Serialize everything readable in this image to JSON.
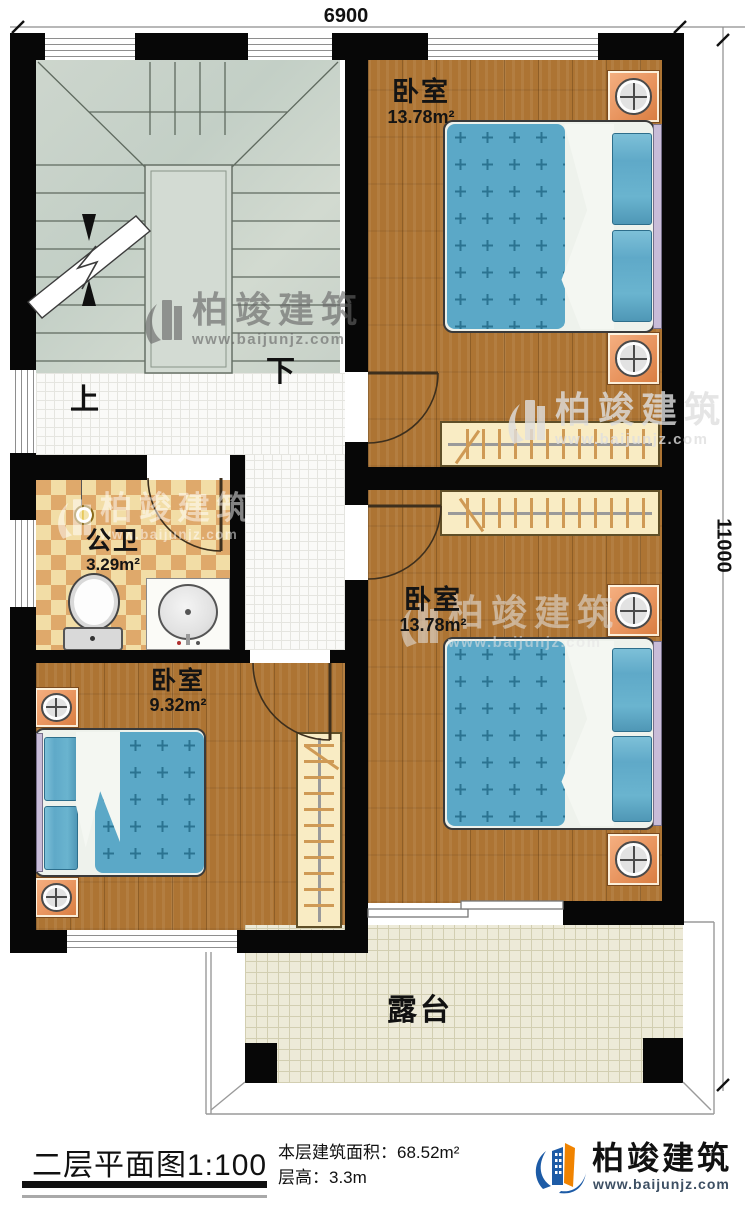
{
  "dimensions": {
    "width_label": "6900",
    "height_label": "11000"
  },
  "stairs": {
    "up_label": "上",
    "down_label": "下"
  },
  "rooms": {
    "bedroom1": {
      "name": "卧室",
      "area": "13.78m²"
    },
    "bedroom2": {
      "name": "卧室",
      "area": "13.78m²"
    },
    "bedroom3": {
      "name": "卧室",
      "area": "9.32m²"
    },
    "bathroom": {
      "name": "公卫",
      "area": "3.29m²"
    },
    "terrace": {
      "name": "露台"
    }
  },
  "legend": {
    "title": "二层平面图",
    "scale": "1:100",
    "area_label": "本层建筑面积：",
    "area_value": "68.52m²",
    "floor_height_label": "层高：",
    "floor_height_value": "3.3m"
  },
  "brand": {
    "name": "柏竣建筑",
    "url": "www.baijunjz.com"
  },
  "watermark": {
    "name": "柏竣建筑",
    "url": "www.baijunjz.com"
  },
  "colors": {
    "wall": "#070707",
    "wood_floor": "#ad7433",
    "bed_blue": "#5ca9c8",
    "stair_gray": "#ccd5cc",
    "bath_tile_light": "#f2dda6",
    "bath_tile_dark": "#dfa96b",
    "terrace_tile": "#edead8",
    "brand_blue": "#1d5ba6",
    "brand_orange": "#f08300"
  }
}
